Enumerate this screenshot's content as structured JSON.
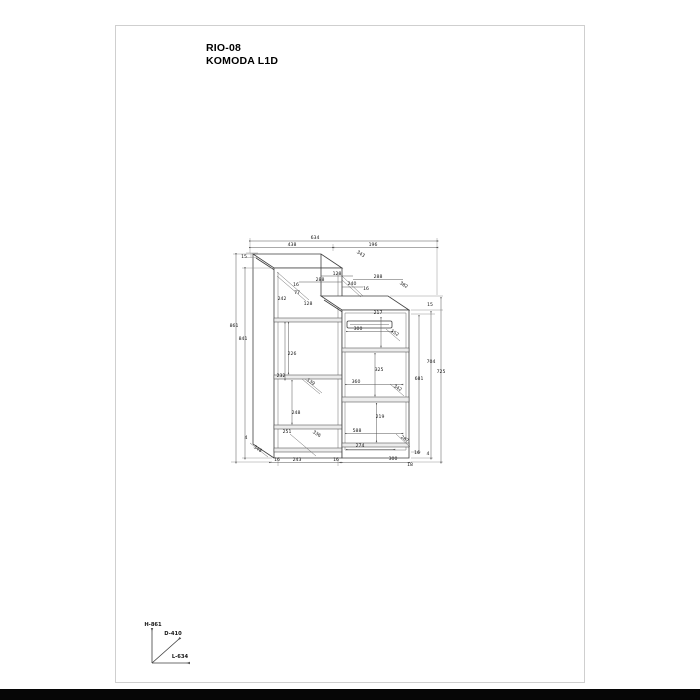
{
  "product": {
    "code": "RIO-08",
    "name": "KOMODA L1D"
  },
  "axis_legend": {
    "height": "H-861",
    "depth": "D-410",
    "length": "L-634"
  },
  "drawing": {
    "labels": [
      {
        "t": "634",
        "x": 315,
        "y": 239
      },
      {
        "t": "438",
        "x": 292,
        "y": 246
      },
      {
        "t": "196",
        "x": 373,
        "y": 246
      },
      {
        "t": "15",
        "x": 244,
        "y": 258
      },
      {
        "t": "343",
        "x": 360,
        "y": 255,
        "r": 33
      },
      {
        "t": "128",
        "x": 337,
        "y": 275
      },
      {
        "t": "288",
        "x": 320,
        "y": 281
      },
      {
        "t": "16",
        "x": 296,
        "y": 286
      },
      {
        "t": "240",
        "x": 352,
        "y": 285
      },
      {
        "t": "16",
        "x": 366,
        "y": 290
      },
      {
        "t": "288",
        "x": 378,
        "y": 278
      },
      {
        "t": "382",
        "x": 403,
        "y": 286,
        "r": 33
      },
      {
        "t": "15",
        "x": 430,
        "y": 306
      },
      {
        "t": "77",
        "x": 297,
        "y": 294
      },
      {
        "t": "242",
        "x": 282,
        "y": 300
      },
      {
        "t": "128",
        "x": 308,
        "y": 305
      },
      {
        "t": "217",
        "x": 378,
        "y": 314
      },
      {
        "t": "300",
        "x": 358,
        "y": 330
      },
      {
        "t": "152",
        "x": 394,
        "y": 334,
        "r": 33
      },
      {
        "t": "861",
        "x": 234,
        "y": 327
      },
      {
        "t": "841",
        "x": 243,
        "y": 340
      },
      {
        "t": "226",
        "x": 292,
        "y": 355
      },
      {
        "t": "232",
        "x": 281,
        "y": 377
      },
      {
        "t": "139",
        "x": 310,
        "y": 383,
        "r": 33
      },
      {
        "t": "325",
        "x": 379,
        "y": 371
      },
      {
        "t": "360",
        "x": 356,
        "y": 383
      },
      {
        "t": "342",
        "x": 397,
        "y": 389,
        "r": 33
      },
      {
        "t": "248",
        "x": 296,
        "y": 414
      },
      {
        "t": "219",
        "x": 380,
        "y": 418
      },
      {
        "t": "588",
        "x": 357,
        "y": 432
      },
      {
        "t": "704",
        "x": 431,
        "y": 363
      },
      {
        "t": "725",
        "x": 441,
        "y": 373
      },
      {
        "t": "681",
        "x": 419,
        "y": 380
      },
      {
        "t": "4",
        "x": 246,
        "y": 439
      },
      {
        "t": "348",
        "x": 257,
        "y": 450,
        "r": 33
      },
      {
        "t": "251",
        "x": 287,
        "y": 433
      },
      {
        "t": "336",
        "x": 316,
        "y": 435,
        "r": 33
      },
      {
        "t": "287",
        "x": 404,
        "y": 440,
        "r": 33
      },
      {
        "t": "274",
        "x": 360,
        "y": 447
      },
      {
        "t": "16",
        "x": 277,
        "y": 461
      },
      {
        "t": "243",
        "x": 297,
        "y": 461
      },
      {
        "t": "16",
        "x": 336,
        "y": 461
      },
      {
        "t": "300",
        "x": 393,
        "y": 460
      },
      {
        "t": "18",
        "x": 410,
        "y": 466
      },
      {
        "t": "16",
        "x": 417,
        "y": 454
      },
      {
        "t": "4",
        "x": 428,
        "y": 455
      }
    ]
  }
}
